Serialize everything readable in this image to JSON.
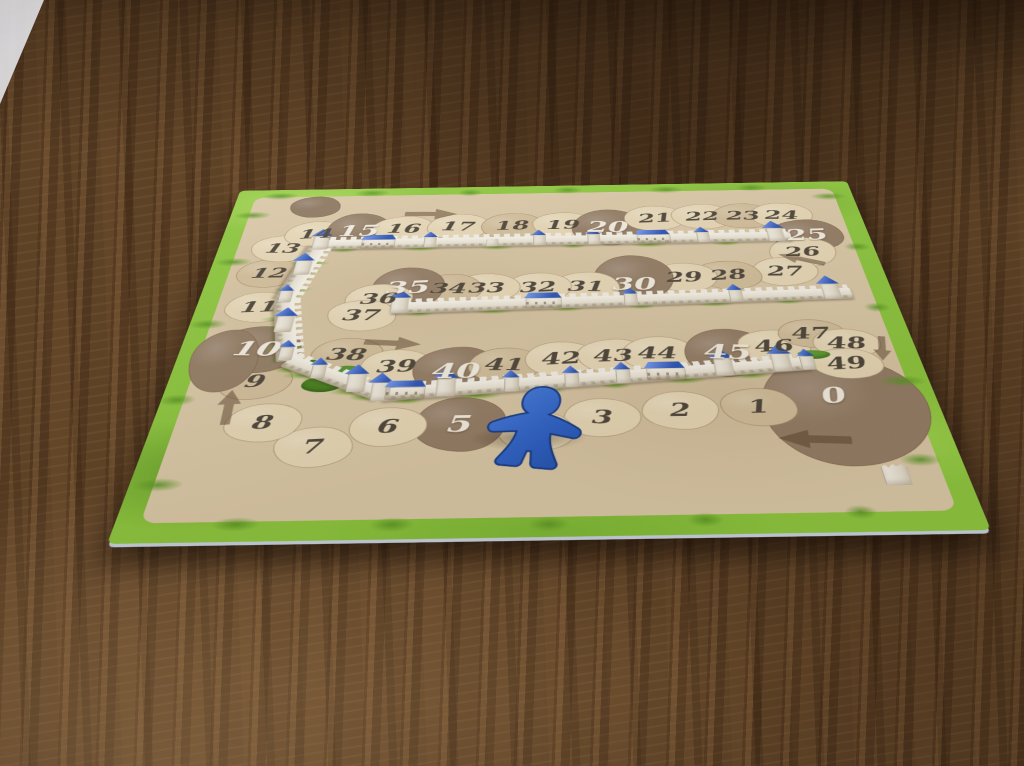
{
  "scene": {
    "setting": "dark wooden table",
    "object": "Carcassonne score track board",
    "board_edge_color": "#b9c2cc"
  },
  "board": {
    "track_spaces": [
      {
        "label": "0",
        "shade": "dark"
      },
      {
        "label": "1",
        "shade": "mid"
      },
      {
        "label": "2",
        "shade": "light"
      },
      {
        "label": "3",
        "shade": "light"
      },
      {
        "label": "",
        "shade": "light",
        "covered_by": "meeple"
      },
      {
        "label": "5",
        "shade": "dark"
      },
      {
        "label": "6",
        "shade": "light"
      },
      {
        "label": "7",
        "shade": "light"
      },
      {
        "label": "8",
        "shade": "light"
      },
      {
        "label": "9",
        "shade": "mid"
      },
      {
        "label": "10",
        "shade": "dark"
      },
      {
        "label": "11",
        "shade": "light"
      },
      {
        "label": "12",
        "shade": "mid"
      },
      {
        "label": "13",
        "shade": "light"
      },
      {
        "label": "14",
        "shade": "light"
      },
      {
        "label": "15",
        "shade": "dark"
      },
      {
        "label": "16",
        "shade": "light"
      },
      {
        "label": "17",
        "shade": "light"
      },
      {
        "label": "18",
        "shade": "mid"
      },
      {
        "label": "19",
        "shade": "light"
      },
      {
        "label": "20",
        "shade": "dark"
      },
      {
        "label": "21",
        "shade": "light"
      },
      {
        "label": "22",
        "shade": "light"
      },
      {
        "label": "23",
        "shade": "mid"
      },
      {
        "label": "24",
        "shade": "light"
      },
      {
        "label": "25",
        "shade": "dark"
      },
      {
        "label": "26",
        "shade": "light"
      },
      {
        "label": "27",
        "shade": "light"
      },
      {
        "label": "28",
        "shade": "mid"
      },
      {
        "label": "29",
        "shade": "light"
      },
      {
        "label": "30",
        "shade": "dark"
      },
      {
        "label": "31",
        "shade": "light"
      },
      {
        "label": "32",
        "shade": "light"
      },
      {
        "label": "33",
        "shade": "light"
      },
      {
        "label": "34",
        "shade": "mid"
      },
      {
        "label": "35",
        "shade": "dark"
      },
      {
        "label": "36",
        "shade": "light"
      },
      {
        "label": "37",
        "shade": "light"
      },
      {
        "label": "38",
        "shade": "mid"
      },
      {
        "label": "39",
        "shade": "light"
      },
      {
        "label": "40",
        "shade": "dark"
      },
      {
        "label": "41",
        "shade": "mid"
      },
      {
        "label": "42",
        "shade": "light"
      },
      {
        "label": "43",
        "shade": "light"
      },
      {
        "label": "44",
        "shade": "light"
      },
      {
        "label": "45",
        "shade": "dark"
      },
      {
        "label": "46",
        "shade": "light"
      },
      {
        "label": "47",
        "shade": "mid"
      },
      {
        "label": "48",
        "shade": "light"
      },
      {
        "label": "49",
        "shade": "light"
      }
    ],
    "direction_arrows": [
      {
        "near_space": "16",
        "direction": "right"
      },
      {
        "near_space": "26",
        "direction": "down-left"
      },
      {
        "near_space": "39",
        "direction": "right"
      },
      {
        "near_space": "8",
        "direction": "up"
      },
      {
        "near_space": "49",
        "direction": "down"
      },
      {
        "near_space": "0",
        "direction": "left"
      }
    ],
    "colors": {
      "grass": "#8cc63e",
      "parchment": "#d9c8a7",
      "patch_light": "#ddcfaf",
      "patch_mid": "#c9b795",
      "patch_dark": "#8d7862",
      "wall": "#efeadb",
      "tower_roof": "#3b63cf",
      "number_dark": "#4e463b",
      "number_white": "#f2ede1"
    }
  },
  "meeple": {
    "color_name": "blue",
    "hex": "#2e63c9",
    "on_space": "4",
    "pose": "lying flat"
  }
}
